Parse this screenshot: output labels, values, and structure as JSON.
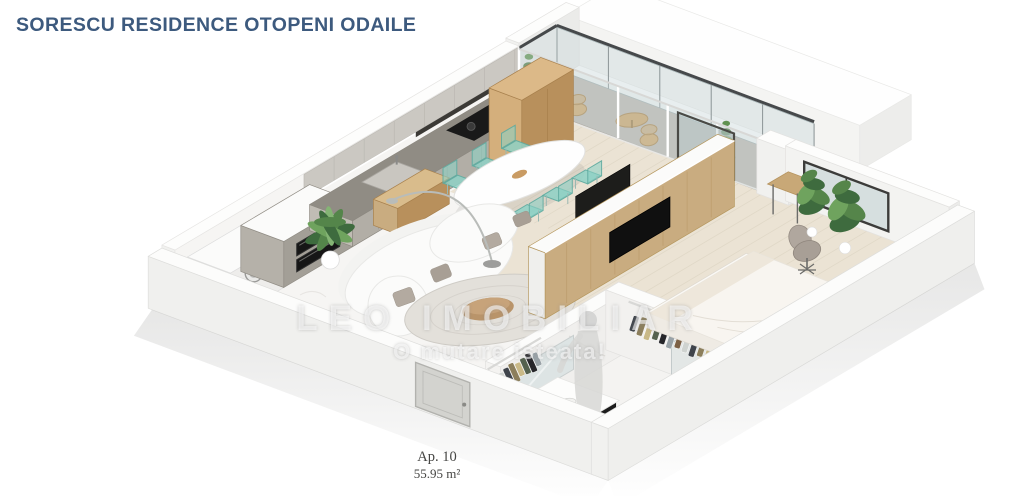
{
  "header": {
    "title": "SORESCU RESIDENCE OTOPENI ODAILE",
    "title_color": "#3d5a7e"
  },
  "watermark": {
    "brand": "LEO IMOBILIAR",
    "slogan": "O mutare isteata!"
  },
  "unit": {
    "label": "Ap. 10",
    "area": "55.95 m²"
  },
  "colors": {
    "background": "#ffffff",
    "floor_wood": "#ebe3d4",
    "floor_marble": "#f6f5f3",
    "balcony_floor": "#b8b5b0",
    "kitchen_cabinet": "#b2aea6",
    "counter_top": "#908c84",
    "oak_wood": "#c9ac80",
    "mint_chair": "#8ed1c5",
    "plant_green": "#55854a",
    "gold_accent": "#c9a24a",
    "dark_fixture": "#1b1b1b",
    "glass": "#cdd8da"
  }
}
